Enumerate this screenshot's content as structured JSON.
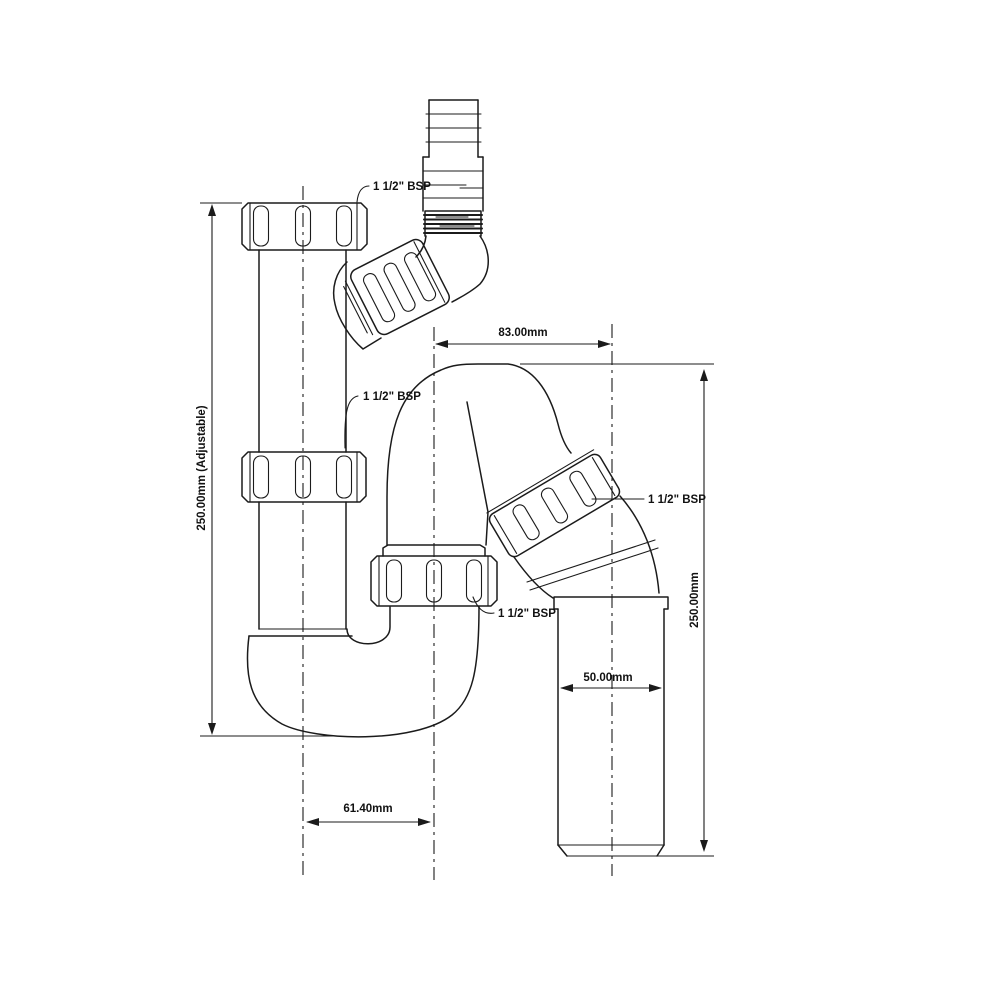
{
  "drawing": {
    "type": "technical-line-drawing",
    "subject": "tubular swivel trap with flexible hose inlet and telescopic adjustment",
    "colors": {
      "line": "#1b1b1b",
      "background": "#ffffff"
    },
    "labels": {
      "bsp_top": "1 1/2\" BSP",
      "bsp_inlet": "1 1/2\" BSP",
      "bsp_outlet": "1 1/2\" BSP",
      "bsp_trap_union": "1 1/2\" BSP"
    },
    "dimensions": {
      "top_width": "83.00mm",
      "left_height": "250.00mm (Adjustable)",
      "right_height": "250.00mm",
      "outlet_diameter": "50.00mm",
      "trap_centres": "61.40mm"
    }
  }
}
